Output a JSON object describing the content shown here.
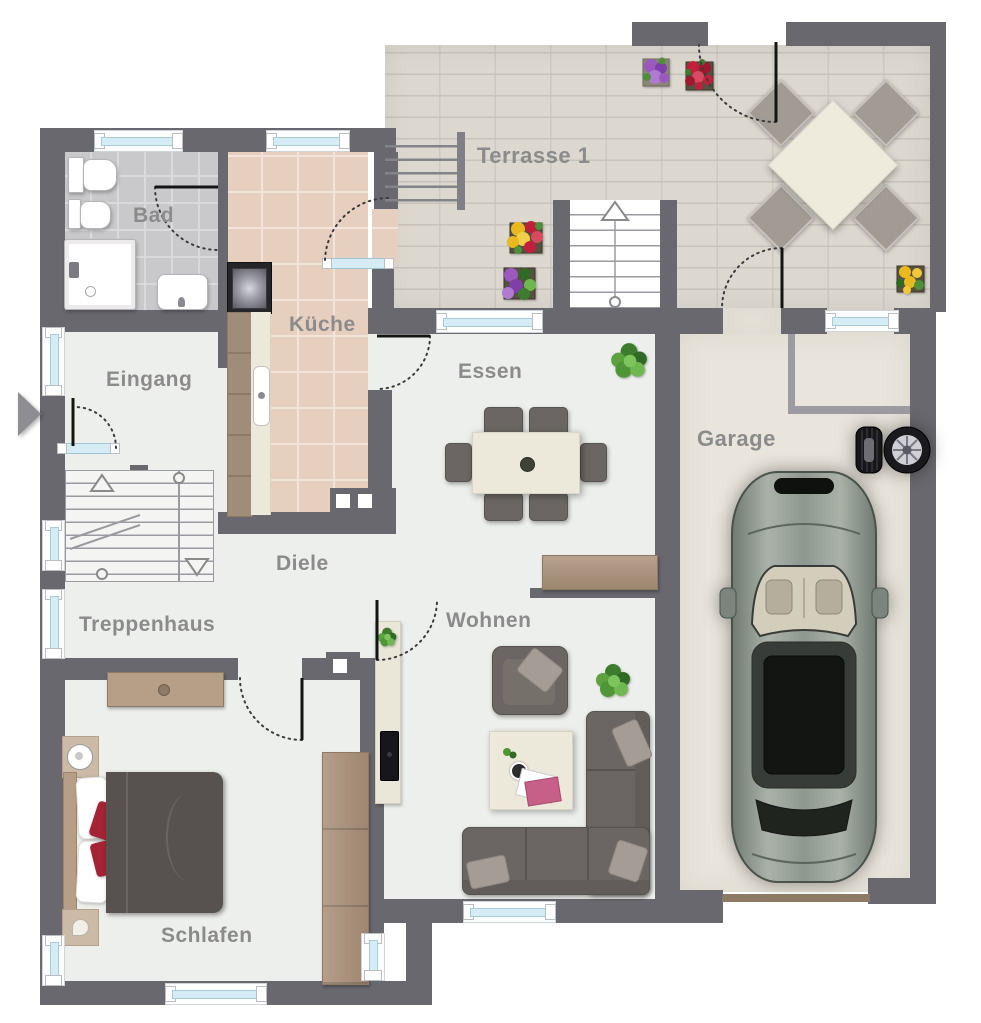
{
  "plan": {
    "rooms": {
      "bad": {
        "label": "Bad"
      },
      "kueche": {
        "label": "Küche"
      },
      "eingang": {
        "label": "Eingang"
      },
      "treppenhaus": {
        "label": "Treppenhaus"
      },
      "diele": {
        "label": "Diele"
      },
      "essen": {
        "label": "Essen"
      },
      "wohnen": {
        "label": "Wohnen"
      },
      "schlafen": {
        "label": "Schlafen"
      },
      "terrasse": {
        "label": "Terrasse 1"
      },
      "garage": {
        "label": "Garage"
      }
    },
    "colors": {
      "wall": "#68686e",
      "floor_main": "#edefec",
      "floor_bad": "#c9c9cc",
      "floor_kueche": "#e6cfbe",
      "floor_terrace": "#dcd8d0",
      "floor_garage": "#e9e5dc",
      "window_glass": "#d6ecf4",
      "wood": "#ab9179",
      "upholstery": "#6b6663",
      "accent_red": "#a42334",
      "label_text": "#8b8b8b"
    },
    "furniture": {
      "bad": [
        "toilet",
        "bidet",
        "shower",
        "washbasin"
      ],
      "kueche": [
        "stove",
        "counter-with-cabinets",
        "kitchen-sink"
      ],
      "treppenhaus": [
        "staircase",
        "sideboard"
      ],
      "essen": [
        "dining-table",
        "six-chairs",
        "plant",
        "sideboard"
      ],
      "wohnen": [
        "tv-sideboard",
        "tv",
        "armchair",
        "coffee-table",
        "corner-sofa",
        "plant"
      ],
      "schlafen": [
        "double-bed",
        "two-nightstands",
        "wardrobe"
      ],
      "terrasse": [
        "patio-table",
        "four-chairs",
        "flower-pots",
        "garden-stairs",
        "exterior-staircase"
      ],
      "garage": [
        "car",
        "spare-wheels"
      ]
    },
    "icons": {
      "entrance_arrow": "right-triangle"
    }
  }
}
